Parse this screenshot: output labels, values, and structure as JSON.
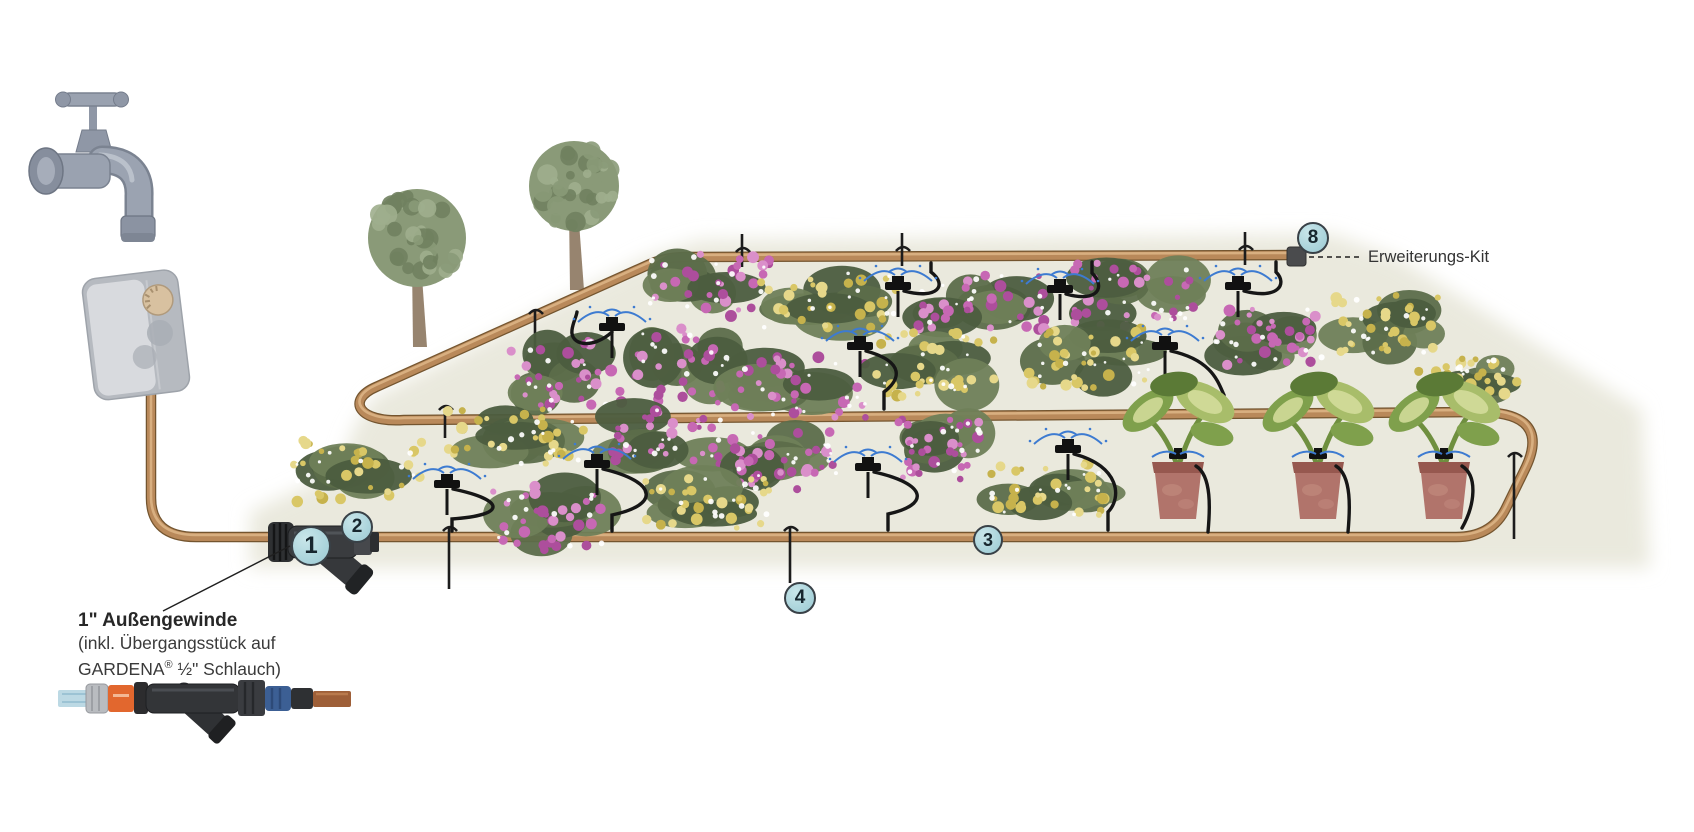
{
  "title": "Micro-Drip irrigation system installation diagram",
  "annotations": {
    "thread_note": {
      "line1": "1\" Außengewinde",
      "line2": "(inkl. Übergangsstück auf",
      "line3_brand": "GARDENA",
      "line3_reg": "®",
      "line3_rest": " ½\" Schlauch)"
    },
    "extension_kit": {
      "label": "Erweiterungs-Kit"
    }
  },
  "markers": [
    {
      "label": "1",
      "x": 311,
      "y": 546,
      "r": 20
    },
    {
      "label": "2",
      "x": 357,
      "y": 527,
      "r": 16
    },
    {
      "label": "3",
      "x": 988,
      "y": 540,
      "r": 15
    },
    {
      "label": "4",
      "x": 800,
      "y": 598,
      "r": 16
    },
    {
      "label": "8",
      "x": 1313,
      "y": 238,
      "r": 16
    }
  ],
  "colors": {
    "page_bg": "#ffffff",
    "bed": "#e9e8db",
    "hose_dark": "#74552f",
    "hose_mid": "#b9895a",
    "hose_light": "#ddb687",
    "tube": "#161616",
    "spray": "#3d7bd1",
    "marker_fill": "#aed6dd",
    "marker_border": "#394147",
    "marker_text": "#17262e",
    "text": "#3a3a3a",
    "pink": [
      "#c768b4",
      "#ad4e9c",
      "#da8fca"
    ],
    "yellow": [
      "#d9c766",
      "#c6b24c",
      "#e6d88a"
    ],
    "green": [
      "#5c6d4a",
      "#6f8059",
      "#4c5d3f"
    ],
    "tree_green": [
      "#8a9a78",
      "#9fae8d",
      "#70815f"
    ],
    "trunk": "#97846f",
    "pot": "#b1746b",
    "pot_dark": "#96584f",
    "leaf": [
      "#7fa04c",
      "#a8bd6a",
      "#d6de9e",
      "#5b7a36"
    ]
  },
  "illustration": {
    "bed_points": "250,568 250,512 340,470 352,432 372,398 645,258 700,240 1332,234 1398,258 1642,410 1650,568",
    "hose_supply": "M 151 386 L 151 498 Q 151 537 196 537 L 300 537",
    "hose_loop": "M 372 537 L 1456 537 Q 1492 537 1506 508 L 1526 467 Q 1540 437 1524 423 Q 1511 412 1478 412 L 404 420 C 358 423 346 400 376 387 L 650 264 Q 666 257 686 257 L 1290 255",
    "end_cap": {
      "x": 1287,
      "y": 247,
      "w": 19,
      "h": 19,
      "rx": 3,
      "fill": "#4a4b4d"
    },
    "leader_lines": [
      {
        "x1": 163,
        "y1": 611,
        "x2": 290,
        "y2": 546,
        "w": 1.4
      },
      {
        "x1": 1309,
        "y1": 257,
        "x2": 1362,
        "y2": 257,
        "w": 1.6,
        "dash": "5 4"
      }
    ],
    "trees": [
      {
        "cx": 417,
        "cy": 238,
        "r": 49,
        "tx": 420,
        "tb": 347
      },
      {
        "cx": 574,
        "cy": 186,
        "r": 45,
        "tx": 577,
        "tb": 290
      }
    ],
    "stakes": [
      {
        "x": 538,
        "y": 320,
        "len": 32,
        "dir": "down"
      },
      {
        "x": 745,
        "y": 258,
        "len": 24,
        "dir": "up"
      },
      {
        "x": 905,
        "y": 257,
        "len": 24,
        "dir": "up"
      },
      {
        "x": 1248,
        "y": 256,
        "len": 24,
        "dir": "up"
      },
      {
        "x": 448,
        "y": 416,
        "len": 22,
        "dir": "down"
      },
      {
        "x": 452,
        "y": 537,
        "len": 52,
        "dir": "down"
      },
      {
        "x": 793,
        "y": 537,
        "len": 46,
        "dir": "down"
      },
      {
        "x": 1517,
        "y": 463,
        "len": 76,
        "dir": "down"
      }
    ],
    "bushes": [
      {
        "x": 708,
        "y": 285,
        "w": 130,
        "h": 72,
        "c": "pink"
      },
      {
        "x": 827,
        "y": 300,
        "w": 150,
        "h": 70,
        "c": "yellow"
      },
      {
        "x": 982,
        "y": 300,
        "w": 135,
        "h": 68,
        "c": "pink"
      },
      {
        "x": 1140,
        "y": 294,
        "w": 140,
        "h": 74,
        "c": "pink"
      },
      {
        "x": 1270,
        "y": 337,
        "w": 122,
        "h": 66,
        "c": "pink"
      },
      {
        "x": 1388,
        "y": 324,
        "w": 112,
        "h": 68,
        "c": "yellow"
      },
      {
        "x": 565,
        "y": 372,
        "w": 120,
        "h": 78,
        "c": "pink"
      },
      {
        "x": 685,
        "y": 365,
        "w": 115,
        "h": 84,
        "c": "pink"
      },
      {
        "x": 803,
        "y": 388,
        "w": 148,
        "h": 70,
        "c": "pink"
      },
      {
        "x": 940,
        "y": 365,
        "w": 135,
        "h": 76,
        "c": "yellow"
      },
      {
        "x": 1090,
        "y": 357,
        "w": 138,
        "h": 70,
        "c": "yellow"
      },
      {
        "x": 1468,
        "y": 380,
        "w": 104,
        "h": 48,
        "c": "yellow"
      },
      {
        "x": 358,
        "y": 472,
        "w": 140,
        "h": 70,
        "c": "yellow"
      },
      {
        "x": 515,
        "y": 437,
        "w": 145,
        "h": 66,
        "c": "yellow"
      },
      {
        "x": 672,
        "y": 436,
        "w": 128,
        "h": 68,
        "c": "pink"
      },
      {
        "x": 784,
        "y": 460,
        "w": 124,
        "h": 68,
        "c": "pink"
      },
      {
        "x": 939,
        "y": 450,
        "w": 96,
        "h": 70,
        "c": "pink"
      },
      {
        "x": 545,
        "y": 518,
        "w": 134,
        "h": 72,
        "c": "pink"
      },
      {
        "x": 706,
        "y": 503,
        "w": 138,
        "h": 64,
        "c": "yellow"
      },
      {
        "x": 1045,
        "y": 490,
        "w": 142,
        "h": 62,
        "c": "yellow"
      }
    ],
    "sprinklers": [
      {
        "x": 612,
        "y": 328,
        "tube": "M 612 332 C 592 350 570 345 572 330 C 573 322 576 318 577 312"
      },
      {
        "x": 898,
        "y": 287,
        "tube": "M 904 291 C 938 300 948 285 931 272 L 931 263"
      },
      {
        "x": 1060,
        "y": 290,
        "tube": "M 1066 294 C 1098 303 1106 287 1092 273 L 1092 262"
      },
      {
        "x": 1238,
        "y": 287,
        "tube": "M 1244 291 C 1278 300 1288 284 1276 272 L 1276 262"
      },
      {
        "x": 860,
        "y": 347,
        "tube": "M 866 351 C 906 362 900 380 884 392 L 884 409"
      },
      {
        "x": 1165,
        "y": 347,
        "tube": "M 1171 351 C 1212 360 1218 382 1224 395 L 1224 409"
      },
      {
        "x": 447,
        "y": 485,
        "tube": "M 453 489 C 505 500 508 515 452 519 L 452 531"
      },
      {
        "x": 597,
        "y": 465,
        "tube": "M 603 469 C 658 482 660 505 612 515 L 612 531"
      },
      {
        "x": 868,
        "y": 468,
        "tube": "M 874 472 C 928 484 930 505 888 514 L 888 530"
      },
      {
        "x": 1068,
        "y": 450,
        "tube": "M 1074 454 C 1120 466 1122 498 1108 512 L 1108 530"
      }
    ],
    "pots": [
      {
        "x": 1152,
        "y": 462,
        "tube": "M 1196 466 C 1212 476 1210 510 1208 532"
      },
      {
        "x": 1292,
        "y": 462,
        "tube": "M 1336 466 C 1352 476 1350 510 1348 532"
      },
      {
        "x": 1418,
        "y": 462,
        "tube": "M 1462 466 C 1478 476 1475 505 1462 528"
      }
    ]
  }
}
